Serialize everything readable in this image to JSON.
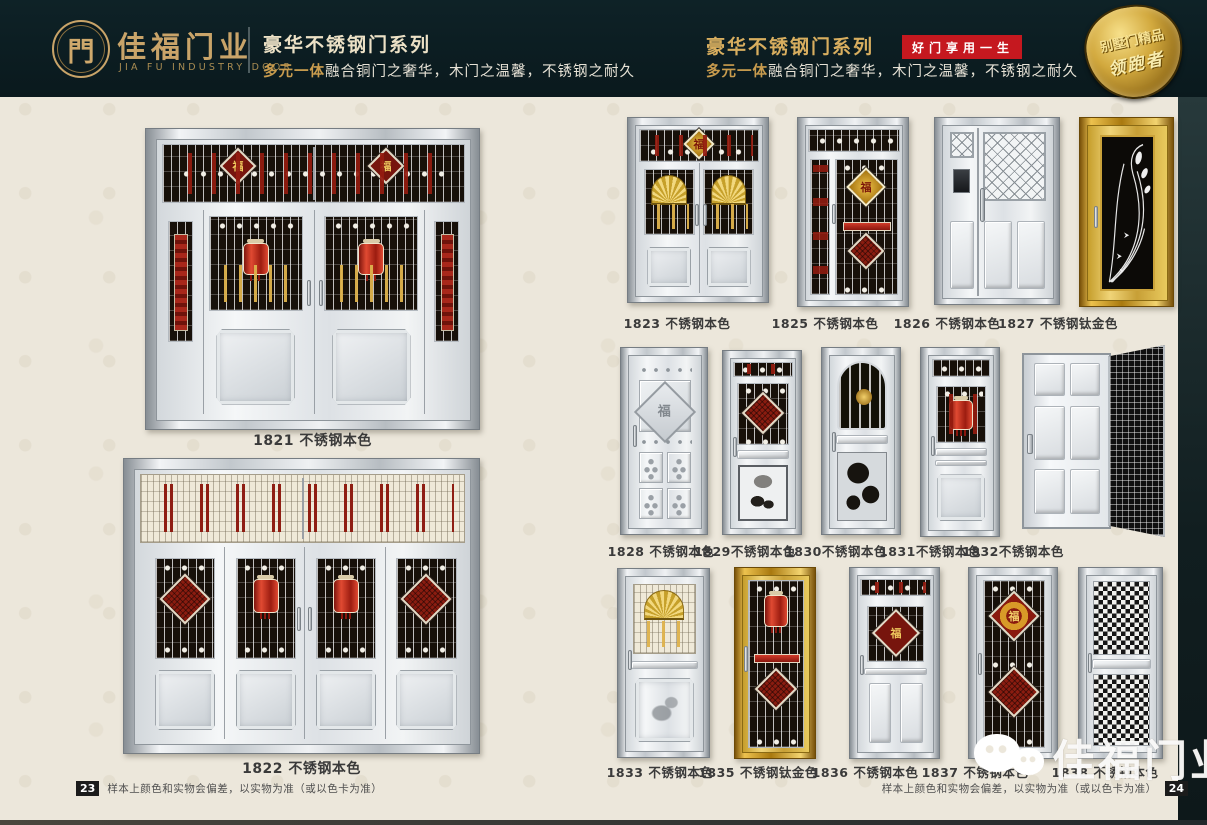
{
  "header": {
    "logo_glyph": "門",
    "brand": "佳福门业",
    "brand_en": "JIA FU INDUSTRY DOOR",
    "left": {
      "title": "豪华不锈钢门系列",
      "sub_accent": "多元一体",
      "sub_rest": "融合铜门之奢华，木门之温馨，不锈钢之耐久"
    },
    "right": {
      "title": "豪华不锈钢门系列",
      "badge": "好门享用一生",
      "sub_accent": "多元一体",
      "sub_rest": "融合铜门之奢华，木门之温馨，不锈钢之耐久",
      "shield_line1": "别墅门精品",
      "shield_line2": "领跑者"
    }
  },
  "doors": [
    {
      "id": "1821",
      "label": "1821 不锈钢本色",
      "variant": "grand-double"
    },
    {
      "id": "1822",
      "label": "1822 不锈钢本色",
      "variant": "grand-quad"
    },
    {
      "id": "1823",
      "label": "1823 不锈钢本色",
      "variant": "double-fan"
    },
    {
      "id": "1825",
      "label": "1825 不锈钢本色",
      "variant": "mother-dark"
    },
    {
      "id": "1826",
      "label": "1826 不锈钢本色",
      "variant": "mother-silver"
    },
    {
      "id": "1827",
      "label": "1827 不锈钢钛金色",
      "variant": "gold-scroll"
    },
    {
      "id": "1828",
      "label": "1828 不锈钢本色",
      "variant": "embossed-squares"
    },
    {
      "id": "1829",
      "label": "1829不锈钢本色",
      "variant": "bird-etch"
    },
    {
      "id": "1830",
      "label": "1830不锈钢本色",
      "variant": "arch-lotus"
    },
    {
      "id": "1831",
      "label": "1831不锈钢本色",
      "variant": "lantern-panel"
    },
    {
      "id": "1832",
      "label": "1832不锈钢本色",
      "variant": "six-panel-screen"
    },
    {
      "id": "1833",
      "label": "1833 不锈钢本色",
      "variant": "fan-panel"
    },
    {
      "id": "1835",
      "label": "1835 不锈钢钛金色",
      "variant": "gold-grille"
    },
    {
      "id": "1836",
      "label": "1836 不锈钢本色",
      "variant": "fu-panels"
    },
    {
      "id": "1837",
      "label": "1837 不锈钢本色",
      "variant": "double-diamond"
    },
    {
      "id": "1838",
      "label": "1838 不锈钢本色",
      "variant": "checker-mesh"
    }
  ],
  "footer_left": {
    "page": "23",
    "note": "样本上颜色和实物会偏差，以实物为准（或以色卡为准）"
  },
  "footer_right": {
    "page": "24",
    "note": "样本上颜色和实物会偏差，以实物为准（或以色卡为准）"
  },
  "watermark": {
    "text": "佳福门业",
    "icon": "wechat-bubbles"
  },
  "colors": {
    "header_bg": "#0b1c21",
    "gold": "#c9a469",
    "badge_red": "#c5181f",
    "titanium_gold": "#caa23a",
    "grille_red": "#8f1d12",
    "page_bg": "#ece7db"
  }
}
